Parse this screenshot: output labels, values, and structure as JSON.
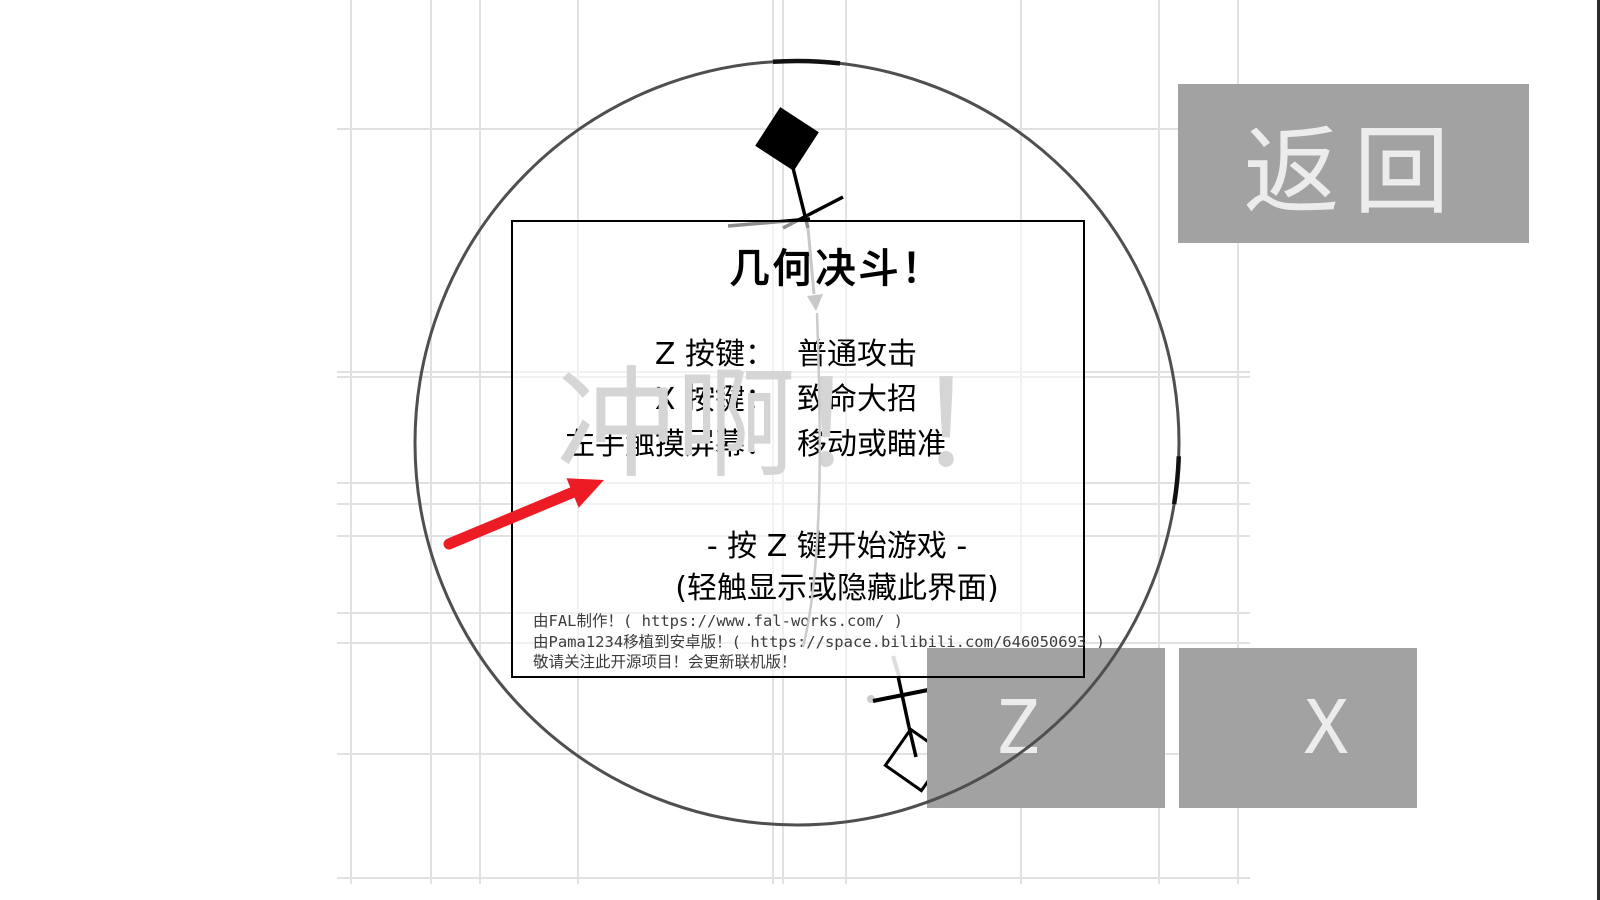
{
  "panel": {
    "title": "几何决斗！",
    "instructions": [
      {
        "key": "Z 按键：",
        "value": "普通攻击"
      },
      {
        "key": "X 按键：",
        "value": "致命大招"
      },
      {
        "key": "左手触摸屏幕：",
        "value": "移动或瞄准"
      }
    ],
    "start_hint": "- 按 Z 键开始游戏 -",
    "toggle_hint": "(轻触显示或隐藏此界面)",
    "credits": [
      "由FAL制作！( https://www.fal-works.com/ )",
      "由Pama1234移植到安卓版！( https://space.bilibili.com/646050693 )",
      "敬请关注此开源项目！会更新联机版！"
    ]
  },
  "background_text": "冲啊！！",
  "buttons": {
    "back_label": "返回",
    "z_label": "Z",
    "x_label": "X"
  },
  "colors": {
    "button_bg": "#a2a2a2",
    "button_text": "#ececec",
    "grid_line": "#e1e1e1",
    "arena_circle": "#4f4f4f",
    "arena_highlight": "#111111",
    "annotation_arrow_red": "#ed1c24",
    "faded_text": "#d5d5d5",
    "aim_line": "#c8c8c8",
    "figure": "#000000"
  },
  "grid": {
    "vertical_x": [
      350,
      430,
      479,
      577,
      772,
      782,
      845,
      1020,
      1158,
      1237
    ],
    "horizontal_y": [
      128,
      371,
      376,
      482,
      503,
      535,
      612,
      642,
      753,
      877
    ],
    "horizontal_span": [
      337,
      1250
    ],
    "vertical_span": [
      0,
      884
    ]
  }
}
